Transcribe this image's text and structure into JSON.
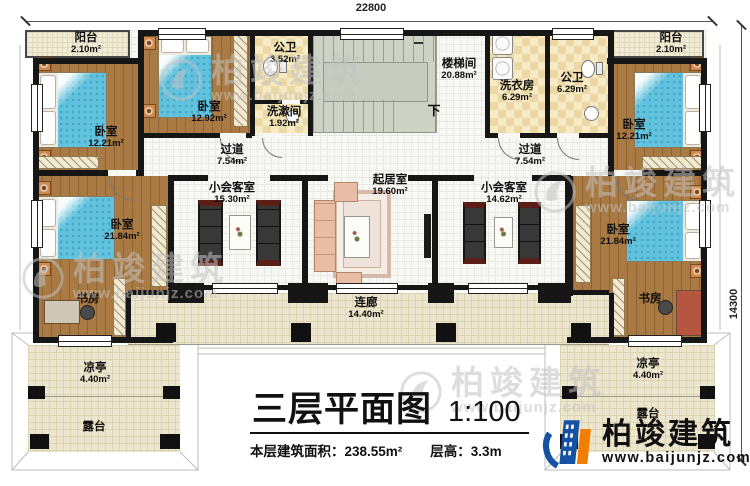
{
  "dimensions": {
    "top": "22800",
    "right": "14300"
  },
  "labels": [
    {
      "name": "阳台",
      "area": "2.10m²"
    },
    {
      "name": "卧室",
      "area": "12.21m²"
    },
    {
      "name": "卧室",
      "area": "12.92m²"
    },
    {
      "name": "公卫",
      "area": "3.52m²"
    },
    {
      "name": "洗漱间",
      "area": "1.92m²"
    },
    {
      "name": "楼梯间",
      "area": "20.88m²"
    },
    {
      "name": "下",
      "area": ""
    },
    {
      "name": "洗衣房",
      "area": "6.29m²"
    },
    {
      "name": "公卫",
      "area": "6.29m²"
    },
    {
      "name": "阳台",
      "area": "2.10m²"
    },
    {
      "name": "卧室",
      "area": "12.21m²"
    },
    {
      "name": "过道",
      "area": "7.54m²"
    },
    {
      "name": "过道",
      "area": "7.54m²"
    },
    {
      "name": "小会客室",
      "area": "15.30m²"
    },
    {
      "name": "起居室",
      "area": "19.60m²"
    },
    {
      "name": "小会客室",
      "area": "14.62m²"
    },
    {
      "name": "卧室",
      "area": "21.84m²"
    },
    {
      "name": "卧室",
      "area": "21.84m²"
    },
    {
      "name": "书房",
      "area": ""
    },
    {
      "name": "书房",
      "area": ""
    },
    {
      "name": "连廊",
      "area": "14.40m²"
    },
    {
      "name": "凉亭",
      "area": "4.40m²"
    },
    {
      "name": "露台",
      "area": ""
    },
    {
      "name": "凉亭",
      "area": "4.40m²"
    },
    {
      "name": "露台",
      "area": ""
    }
  ],
  "title_block": {
    "title": "三层平面图",
    "scale": "1:100",
    "info_area": "本层建筑面积：238.55m²",
    "info_height": "层高：3.3m"
  },
  "brand": {
    "name": "柏竣建筑",
    "website": "www.baijunjz.com"
  },
  "watermark": {
    "name": "柏竣建筑",
    "website": "www.baijunjz.com"
  },
  "colors": {
    "wall": "#161616",
    "wood_floor": "#a97a43",
    "tile_cream": "#ebe6cd",
    "checker": "#ecd8a4",
    "stair": "#ccd3c5",
    "bed_blue": "#62c2de",
    "brand_blue": "#1652a3",
    "brand_orange": "#f07e00"
  }
}
